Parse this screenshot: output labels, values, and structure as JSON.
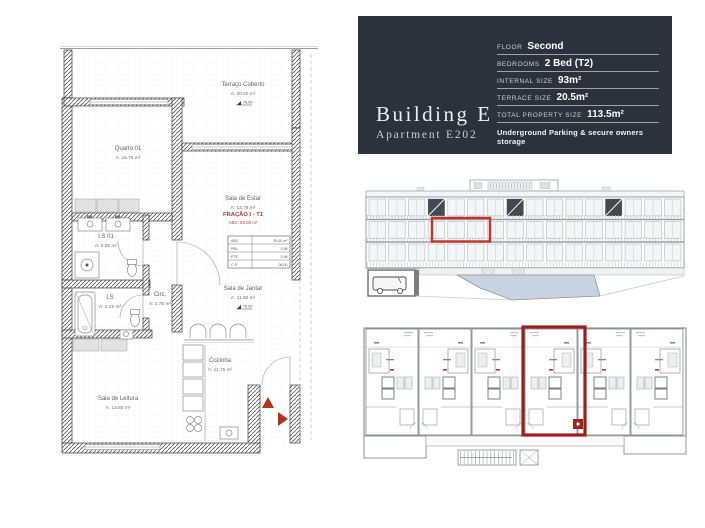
{
  "info_panel": {
    "building_title": "Building E",
    "apartment_subtitle": "Apartment E202",
    "specs": [
      {
        "label": "FLOOR",
        "value": "Second"
      },
      {
        "label": "BEDROOMS",
        "value": "2 Bed (T2)"
      },
      {
        "label": "INTERNAL SIZE",
        "value": "93m²"
      },
      {
        "label": "TERRACE SIZE",
        "value": "20.5m²"
      },
      {
        "label": "TOTAL PROPERTY SIZE",
        "value": "113.5m²"
      }
    ],
    "note": "Underground Parking & secure owners storage",
    "colors": {
      "background": "#2c313b",
      "text": "#ffffff"
    }
  },
  "floorplan": {
    "rooms": [
      {
        "name": "Terraço Coberto",
        "area": "A: 20.50 m²"
      },
      {
        "name": "Quarto 01",
        "area": "A: 16.75 m²"
      },
      {
        "name": "Sala de Estar",
        "area": "A: 13.78 m²"
      },
      {
        "name": "I.S 01",
        "area": "A: 5.00 m²"
      },
      {
        "name": "I.S",
        "area": "A: 4.25 m²"
      },
      {
        "name": "Circ.",
        "area": "A: 2.75 m²"
      },
      {
        "name": "Sala de Jantar",
        "area": "A: 11.50 m²"
      },
      {
        "name": "Cozinha",
        "area": "A: 11.75 m²"
      },
      {
        "name": "Sala de Leitura",
        "area": "A: 13.50 m²"
      }
    ],
    "fraction": {
      "title": "FRAÇÃO I - T1",
      "abc": "ABC: 93.00 m²"
    },
    "area_table": {
      "rows": [
        [
          "ABC",
          "93.00 m²"
        ],
        [
          "PBL",
          "2.98"
        ],
        [
          "PTE",
          "2.98"
        ],
        [
          "C.P.",
          "06.00"
        ]
      ]
    },
    "level_markers": {
      "terrace": "76.50",
      "dining": "76.50"
    },
    "accent_red": "#b03a2e"
  },
  "elevation": {
    "highlight_color": "#c3332b"
  },
  "site_plan": {
    "highlight_color": "#9e1d1d"
  }
}
